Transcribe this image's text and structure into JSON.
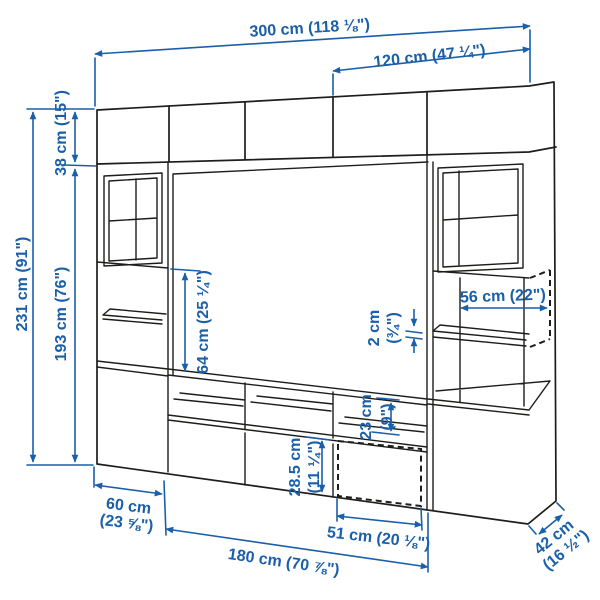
{
  "image": {
    "type": "product-dimensions-illustration",
    "subject": "tv-storage-combination",
    "background_color": "#ffffff",
    "outline_color": "#1d1d1b",
    "dimension_color": "#1a5fa9"
  },
  "labels": {
    "total_width": "300 cm (118 ⅛\")",
    "section_width": "120 cm (47 ¼\")",
    "total_height": "231 cm (91\")",
    "top_cabinet_height": "38 cm (15\")",
    "base_height": "193 cm (76\")",
    "tv_space_height": "64 cm (25 ¼\")",
    "inner_width": "56 cm (22\")",
    "shelf_thickness_value": "2 cm",
    "shelf_thickness_inches": "(¾\")",
    "compartment_height_value": "23 cm",
    "compartment_height_inches": "(9\")",
    "drawer_height_value": "28.5 cm",
    "drawer_height_inches": "(11 ¼\")",
    "door_width": "51 cm (20 ⅛\")",
    "bench_width": "180 cm (70 ⅞\")",
    "side_unit_width_value": "60 cm",
    "side_unit_width_inches": "(23 ⅝\")",
    "depth_value": "42 cm",
    "depth_inches": "(16 ½\")"
  }
}
